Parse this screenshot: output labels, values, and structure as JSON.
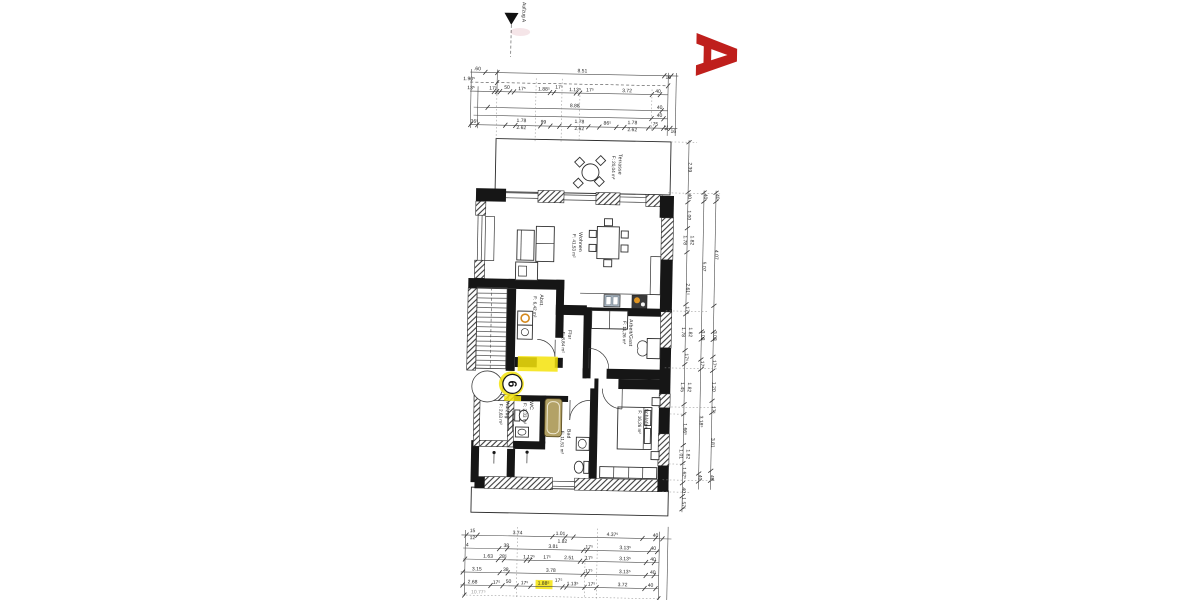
{
  "plan_letter": {
    "text": "A",
    "color": "#bf1f1c"
  },
  "section_marker": {
    "label": "Aufzug A"
  },
  "entrance_badge": {
    "number": "6",
    "highlight_color": "#f4e30b"
  },
  "rooms": [
    {
      "name": "Terrasse",
      "area": "F: 20,04 m²",
      "x": 616,
      "y": 153
    },
    {
      "name": "Wohnen",
      "area": "F: 41,53 m²",
      "x": 578,
      "y": 232
    },
    {
      "name": "Abst.",
      "area": "F: 6,42 m²",
      "x": 540,
      "y": 295
    },
    {
      "name": "Flur",
      "area": "F: 8,84 m²",
      "x": 569,
      "y": 330
    },
    {
      "name": "Arbeit/Gast",
      "area": "F: 11,26 m²",
      "x": 630,
      "y": 318
    },
    {
      "name": "Aufzug",
      "area": "F: 2,63 m²",
      "x": 508,
      "y": 403
    },
    {
      "name": "WC",
      "area": "F: 3,33 m²",
      "x": 532,
      "y": 402
    },
    {
      "name": "Bad",
      "area": "F: 11,51 m²",
      "x": 570,
      "y": 429
    },
    {
      "name": "Schlafen",
      "area": "F: 16,26 m²",
      "x": 647,
      "y": 407
    }
  ],
  "dims_top": {
    "rows": [
      {
        "labels": [
          {
            "t": ".60",
            "x": 473,
            "y": 72
          },
          {
            "t": "8.51",
            "x": 578
          },
          {
            "t": "16",
            "x": 664,
            "y": 77
          }
        ]
      },
      {
        "labels": [
          {
            "t": "1.90⁵",
            "x": 465
          }
        ]
      },
      {
        "labels": [
          {
            "t": "13⁵",
            "x": 467
          },
          {
            "t": "17⁵",
            "x": 489
          },
          {
            "t": "50",
            "x": 503,
            "y": 90
          },
          {
            "t": "17⁵",
            "x": 518
          },
          {
            "t": "1.88⁵",
            "x": 540
          },
          {
            "t": "17⁵",
            "x": 555,
            "y": 89
          },
          {
            "t": "1.13⁵",
            "x": 571
          },
          {
            "t": "17⁵",
            "x": 586
          },
          {
            "t": "3.72",
            "x": 623
          },
          {
            "t": "40",
            "x": 654
          }
        ]
      },
      {
        "labels": [
          {
            "t": "8.88",
            "x": 571
          },
          {
            "t": "40",
            "x": 656
          }
        ]
      },
      {
        "labels": [
          {
            "t": "40",
            "x": 656
          }
        ]
      },
      {
        "labels": [
          {
            "t": "36⁵",
            "x": 471
          },
          {
            "t": "1.78",
            "x": 518,
            "y": 123
          },
          {
            "t": "2.62",
            "x": 518,
            "y": 130
          },
          {
            "t": "99",
            "x": 540,
            "y": 124
          },
          {
            "t": "1.78",
            "x": 576,
            "y": 123
          },
          {
            "t": "2.62",
            "x": 576,
            "y": 130
          },
          {
            "t": "86⁵",
            "x": 604,
            "y": 124
          },
          {
            "t": "1.78",
            "x": 629,
            "y": 123
          },
          {
            "t": "2.62",
            "x": 629,
            "y": 130
          },
          {
            "t": "75",
            "x": 652,
            "y": 124
          },
          {
            "t": "24",
            "x": 661,
            "y": 126,
            "rot": 90
          },
          {
            "t": "16",
            "x": 670,
            "y": 131
          }
        ]
      }
    ]
  },
  "dims_bottom": {
    "rows": [
      {
        "labels": [
          {
            "t": "15",
            "x": 477,
            "y": 534
          },
          {
            "t": "12",
            "x": 477,
            "y": 541
          },
          {
            "t": "3.74",
            "x": 522
          },
          {
            "t": "1.01",
            "x": 565
          },
          {
            "t": "1.82",
            "x": 567,
            "y": 543
          },
          {
            "t": "4.37⁵",
            "x": 617
          },
          {
            "t": "40",
            "x": 660
          }
        ]
      },
      {
        "labels": [
          {
            "t": "4",
            "x": 472
          },
          {
            "t": "38",
            "x": 511
          },
          {
            "t": "3.81",
            "x": 558
          },
          {
            "t": "17⁵",
            "x": 594
          },
          {
            "t": "3.13⁵",
            "x": 630
          },
          {
            "t": "40",
            "x": 658
          }
        ]
      },
      {
        "labels": [
          {
            "t": "1.63",
            "x": 493
          },
          {
            "t": "28⁵",
            "x": 508
          },
          {
            "t": "1.12⁵",
            "x": 534
          },
          {
            "t": "17⁵",
            "x": 552
          },
          {
            "t": "2.51",
            "x": 574
          },
          {
            "t": "17⁵",
            "x": 594
          },
          {
            "t": "3.13⁵",
            "x": 630
          },
          {
            "t": "40",
            "x": 658
          }
        ]
      },
      {
        "labels": [
          {
            "t": "3.15",
            "x": 482
          },
          {
            "t": "38",
            "x": 511
          },
          {
            "t": "3.78",
            "x": 556
          },
          {
            "t": "17⁵",
            "x": 594
          },
          {
            "t": "3.13⁵",
            "x": 630
          },
          {
            "t": "40",
            "x": 658
          }
        ]
      },
      {
        "labels": [
          {
            "t": "2.68",
            "x": 478
          },
          {
            "t": "17⁵",
            "x": 502
          },
          {
            "t": "50",
            "x": 514,
            "y": 584
          },
          {
            "t": "17⁵",
            "x": 530
          },
          {
            "t": "1.88⁵",
            "x": 549
          },
          {
            "t": "17⁵",
            "x": 564,
            "y": 582
          },
          {
            "t": "1.13⁵",
            "x": 578
          },
          {
            "t": "17⁵",
            "x": 597
          },
          {
            "t": "3.72",
            "x": 628
          },
          {
            "t": "40",
            "x": 656
          }
        ]
      },
      {
        "labels": [
          {
            "t": "10.77⁵",
            "x": 484,
            "faint": true
          }
        ]
      }
    ]
  },
  "dims_right": {
    "chains": [
      {
        "labels": [
          {
            "t": "2.39",
            "y": 165
          },
          {
            "t": "40",
            "y": 194
          },
          {
            "t": "1.00",
            "y": 213
          },
          {
            "t": "1.78",
            "y": 238,
            "dx": -3.5
          },
          {
            "t": "1.82",
            "y": 238,
            "dx": 3.5
          },
          {
            "t": "2.61⁵",
            "y": 287
          },
          {
            "t": "17⁵",
            "y": 308
          },
          {
            "t": "1.78",
            "y": 330,
            "dx": -3.5
          },
          {
            "t": "1.82",
            "y": 330,
            "dx": 3.5
          },
          {
            "t": "17⁵",
            "y": 355
          },
          {
            "t": "1.45",
            "y": 385,
            "dx": -3.5
          },
          {
            "t": "1.82",
            "y": 385,
            "dx": 3.5
          },
          {
            "t": "1.66⁵",
            "y": 427
          },
          {
            "t": "1.01",
            "y": 452,
            "dx": -3.5
          },
          {
            "t": "1.82",
            "y": 452,
            "dx": 3.5
          },
          {
            "t": "1.62⁵",
            "y": 471
          },
          {
            "t": "40",
            "y": 488
          },
          {
            "t": "1.57⁵",
            "y": 501
          }
        ]
      },
      {
        "labels": [
          {
            "t": "40",
            "y": 194
          },
          {
            "t": "5.07",
            "y": 264
          },
          {
            "t": "3.03",
            "y": 333
          },
          {
            "t": "17⁵",
            "y": 362
          },
          {
            "t": "3.18⁵",
            "y": 419
          },
          {
            "t": "40",
            "y": 475
          }
        ]
      },
      {
        "labels": [
          {
            "t": "40",
            "y": 194
          },
          {
            "t": "4.07",
            "y": 252
          },
          {
            "t": "3.03",
            "y": 333
          },
          {
            "t": "17⁵",
            "y": 361
          },
          {
            "t": "1.20",
            "y": 384
          },
          {
            "t": "17⁵",
            "y": 407
          },
          {
            "t": "3.81",
            "y": 440
          },
          {
            "t": "40",
            "y": 475
          }
        ]
      }
    ]
  }
}
